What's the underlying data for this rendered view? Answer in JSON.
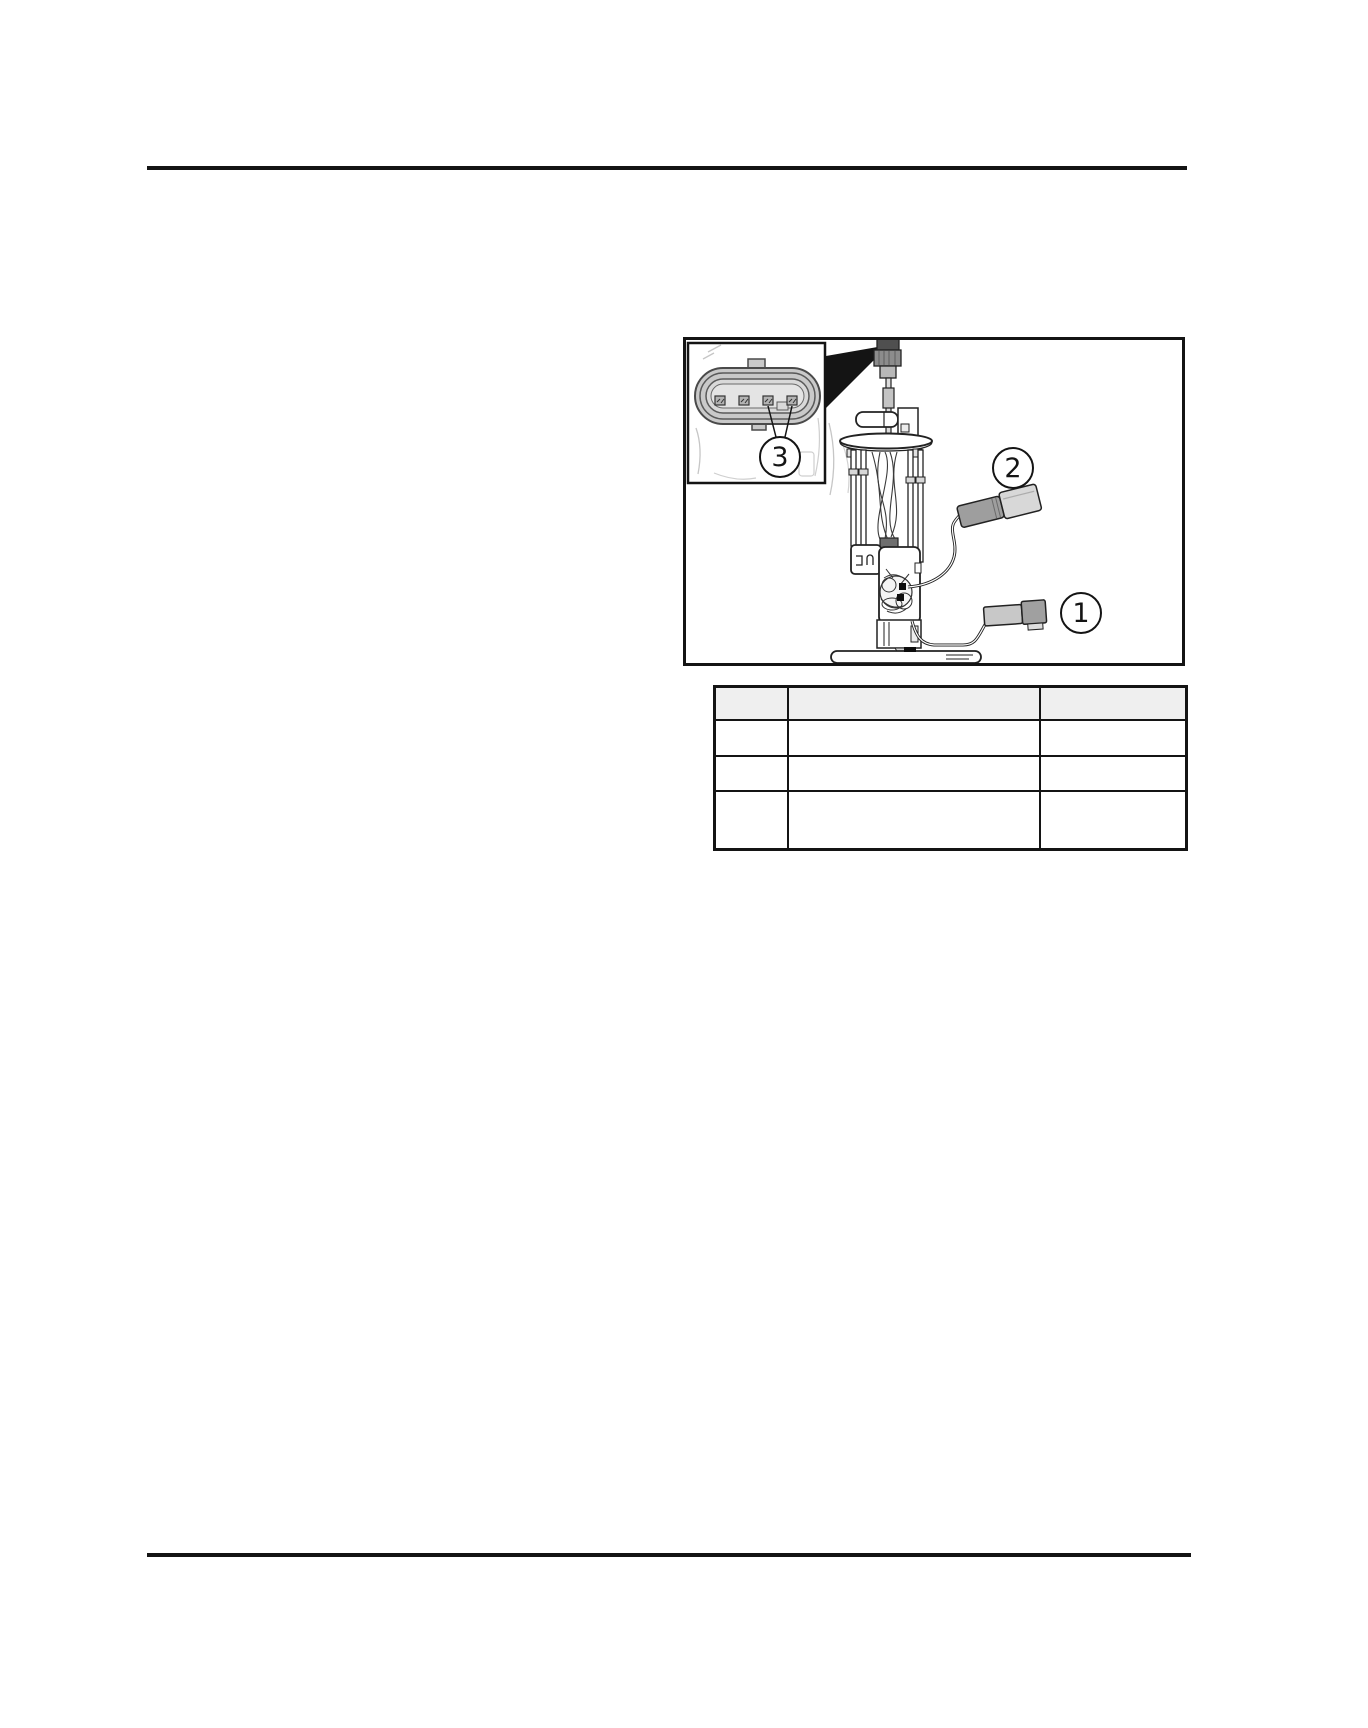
{
  "figure": {
    "alt": "Fuel pump module assembly with 4-pin electrical connector inset",
    "callouts": [
      {
        "label": "1"
      },
      {
        "label": "2"
      },
      {
        "label": "3"
      }
    ]
  },
  "table": {
    "header": [
      "",
      "",
      ""
    ],
    "rows": [
      [
        "",
        "",
        ""
      ],
      [
        "",
        "",
        ""
      ],
      [
        "",
        "",
        ""
      ]
    ]
  },
  "colors": {
    "rule": "#141414",
    "table_header_bg": "#efefef",
    "diagram_gray": "#c9c9c9"
  }
}
